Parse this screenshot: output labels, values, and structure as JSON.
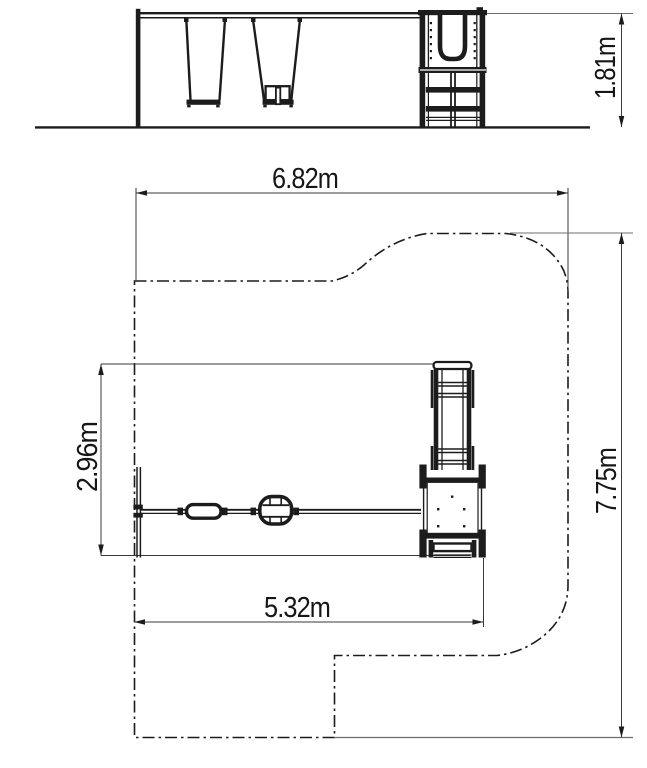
{
  "colors": {
    "line": "#1c1c1c",
    "dim_line": "#3a3a3a",
    "ext_line": "#6e6e6e",
    "background": "#ffffff"
  },
  "elevation": {
    "height_dim": "1.81m"
  },
  "plan": {
    "zone_width_dim": "6.82m",
    "zone_depth_dim": "7.75m",
    "equipment_width_dim": "5.32m",
    "equipment_depth_dim": "2.96m"
  }
}
